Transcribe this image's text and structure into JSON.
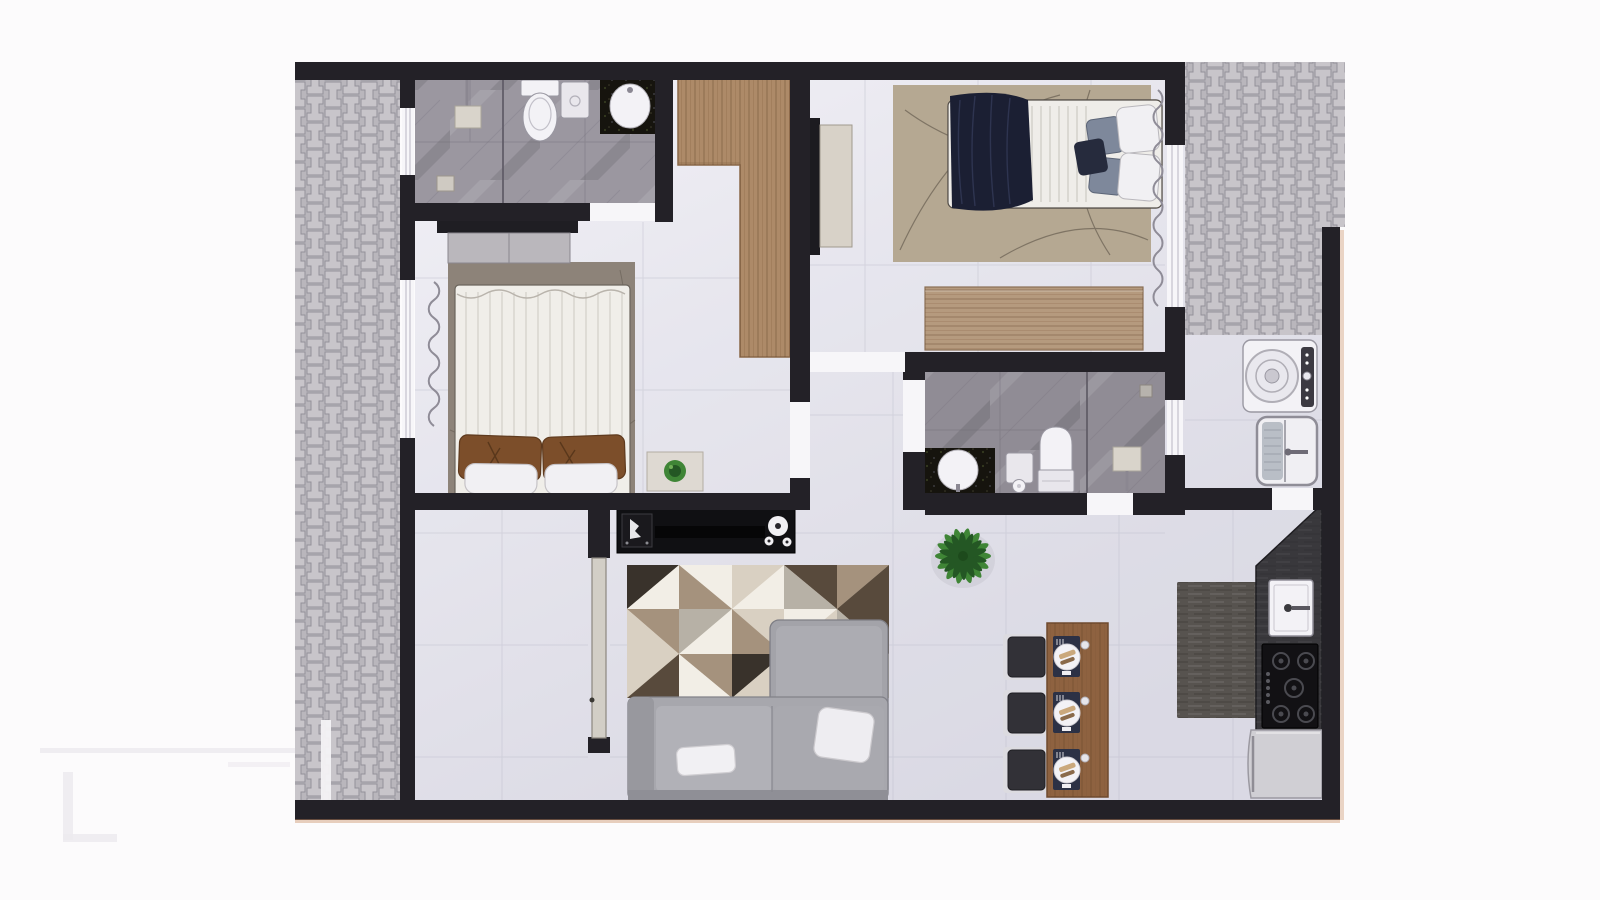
{
  "scene": {
    "description": "Top-down 3D architectural render of a two-bedroom apartment floor plan, no visible text labels",
    "visible_text": []
  },
  "colors": {
    "bg": "#fcfbfc",
    "wall": "#232127",
    "wall_dark": "#17161a",
    "tile_light": "#f0eff6",
    "tile_mid": "#e2e1ea",
    "tile_dark": "#d6d5e1",
    "grout": "#b6b6c6",
    "paver_base": "#b9b6bc",
    "paver_block": "#c8c5ca",
    "paver_line": "#94919a",
    "marble": "#9b97a0",
    "marble2": "#908c95",
    "marble_line": "#6f6b76",
    "glass": "#5f5b66",
    "wood": "#ad8a68",
    "wood_dark": "#8a6848",
    "wood_light": "#b59a7e",
    "table": "#8e6240",
    "table_dark": "#6f4a2e",
    "counter": "#39383c",
    "granite": "#16140e",
    "fixture_white": "#f3f2f6",
    "fixture_line": "#9a98a2",
    "threshold": "#f7f6f9",
    "sofa": "#a7a7ad",
    "sofa_dark": "#8f8f96",
    "sofa_light": "#b1b1b7",
    "cushion_white": "#f1f0f3",
    "rug_beige": "#b5a892",
    "rug_line_dark": "#4a4238",
    "rug_master": "#8d8379",
    "rug_kitchen": "#57534f",
    "navy": "#1b1f33",
    "navy_fold": "#2e3450",
    "pillow_brown": "#7c4e2a",
    "pillow_brown_dark": "#5e3a1e",
    "pillow_gray": "#7e889b",
    "plant": "#3f8536",
    "plant_dark": "#245724",
    "chair": "#323137",
    "chair_frame": "#dcdbe0",
    "placemat": "#2c3145",
    "fridge": "#d0cfd4",
    "curtain": "#8f8c97",
    "door_leaf": "#d2cec6",
    "tv_black": "#101013",
    "speaker_white": "#e8e8ea",
    "watermark": "#eceaef",
    "accent_warm": "#c98b5e",
    "rug_w": "#f2eee6",
    "rug_lt": "#d9d0c2",
    "rug_md": "#a5927d",
    "rug_dk": "#584a3c",
    "rug_bk": "#39322b",
    "rug_gy": "#b7b1a6"
  },
  "rooms": [
    {
      "name": "ensuite-bathroom",
      "furniture": [
        "shower-column",
        "glass-partition",
        "toilet",
        "wall-cabinet",
        "round-sink-dark-counter",
        "floor-drain",
        "window"
      ]
    },
    {
      "name": "master-bedroom",
      "furniture": [
        "double-bed-white-duvet",
        "brown-pillows",
        "white-pillows",
        "dresser",
        "area-rug",
        "side-table-with-plant",
        "l-shaped-wardrobe",
        "curtain",
        "window"
      ]
    },
    {
      "name": "bedroom-2",
      "furniture": [
        "double-bed-navy-blanket",
        "gray-pillows",
        "white-pillows",
        "tv-panel",
        "wood-sideboard",
        "beige-rug",
        "curtain",
        "window"
      ]
    },
    {
      "name": "bathroom-2",
      "furniture": [
        "round-sink-dark-counter",
        "toilet",
        "cabinet-toilet-paper",
        "shower-plate",
        "glass-partition",
        "drain",
        "window"
      ]
    },
    {
      "name": "laundry",
      "furniture": [
        "washing-machine",
        "laundry-tank-sink"
      ]
    },
    {
      "name": "kitchen",
      "furniture": [
        "dark-l-counter",
        "kitchen-sink",
        "gas-cooktop-5-burners",
        "refrigerator",
        "runner-rug"
      ]
    },
    {
      "name": "living-room",
      "furniture": [
        "tv-console",
        "speaker-box",
        "round-speakers",
        "geometric-rug",
        "sectional-sofa",
        "white-throw-pillows",
        "potted-plant"
      ]
    },
    {
      "name": "dining-area",
      "furniture": [
        "wood-dining-table",
        "dining-chair",
        "dining-chair",
        "dining-chair",
        "place-setting",
        "place-setting",
        "place-setting"
      ]
    },
    {
      "name": "entry-hall",
      "furniture": [
        "entry-door-leaf"
      ]
    },
    {
      "name": "outdoor",
      "furniture": [
        "paver-patio-left",
        "paver-patio-top-right",
        "walkway-strip"
      ]
    }
  ]
}
